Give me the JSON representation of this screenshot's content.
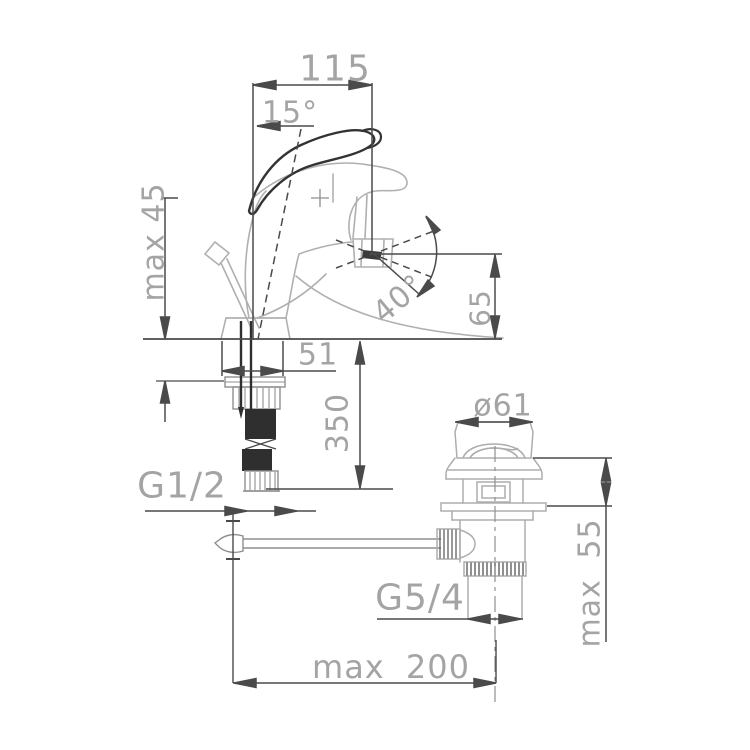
{
  "drawing": {
    "subject": "bidet mixer faucet with pop-up waste technical dimension drawing",
    "colors": {
      "background": "#ffffff",
      "dimension_line": "#4a4a4a",
      "body_line": "#b0b0b0",
      "dark_part": "#2f2f2f",
      "label_text": "#a4a4a4"
    },
    "labels": {
      "width_top": "115",
      "handle_angle": "15°",
      "max_deck_faucet": "max 45",
      "swivel_angle": "40°",
      "spout_height": "65",
      "base_width": "51",
      "hose_length": "350",
      "inlet_thread": "G1/2",
      "waste_diameter": "ø61",
      "max_deck_waste": "max 55",
      "waste_thread": "G5/4",
      "rod_reach": "max 200"
    }
  }
}
